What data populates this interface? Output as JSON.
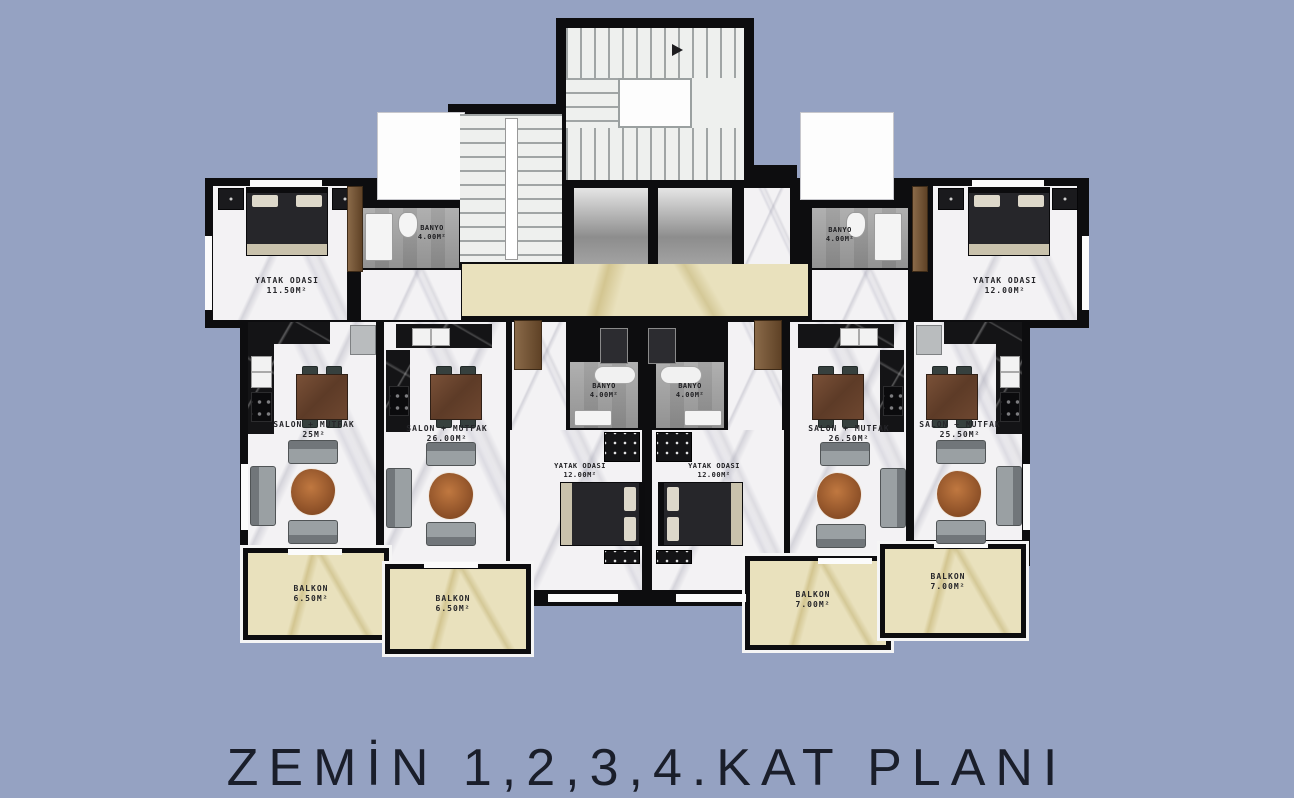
{
  "title": "ZEMİN 1,2,3,4.KAT PLANI",
  "plan": {
    "background_color": "#95a2c2",
    "wall_color": "#0d0d0f",
    "floor_white_marble": "#f3f2f4",
    "floor_cream_marble": "#e9e1bd",
    "floor_gray_tile": "#9c9c9c",
    "kitchen_counter_color": "#141416",
    "balcony_trim_color": "#f5f5f5"
  },
  "rooms": {
    "u1_bedroom": {
      "name": "YATAK ODASI",
      "area": "11.50M²"
    },
    "u1_banyo": {
      "name": "BANYO",
      "area": "4.00M²"
    },
    "u1_salon": {
      "name": "SALON + MUTFAK",
      "area": "25M²"
    },
    "u1_balkon": {
      "name": "BALKON",
      "area": "6.50M²"
    },
    "u2_salon": {
      "name": "SALON + MUTFAK",
      "area": "26.00M²"
    },
    "u2_banyo": {
      "name": "BANYO",
      "area": "4.00M²"
    },
    "u2_bedroom": {
      "name": "YATAK ODASI",
      "area": "12.00M²"
    },
    "u2_balkon": {
      "name": "BALKON",
      "area": "6.50M²"
    },
    "u3_banyo": {
      "name": "BANYO",
      "area": "4.00M²"
    },
    "u3_bedroom": {
      "name": "YATAK ODASI",
      "area": "12.00M²"
    },
    "u3_salon": {
      "name": "SALON + MUTFAK",
      "area": "26.50M²"
    },
    "u3_balkon": {
      "name": "BALKON",
      "area": "7.00M²"
    },
    "u4_bedroom": {
      "name": "YATAK ODASI",
      "area": "12.00M²"
    },
    "u4_banyo": {
      "name": "BANYO",
      "area": "4.00M²"
    },
    "u4_salon": {
      "name": "SALON + MUTFAK",
      "area": "25.50M²"
    },
    "u4_balkon": {
      "name": "BALKON",
      "area": "7.00M²"
    }
  }
}
